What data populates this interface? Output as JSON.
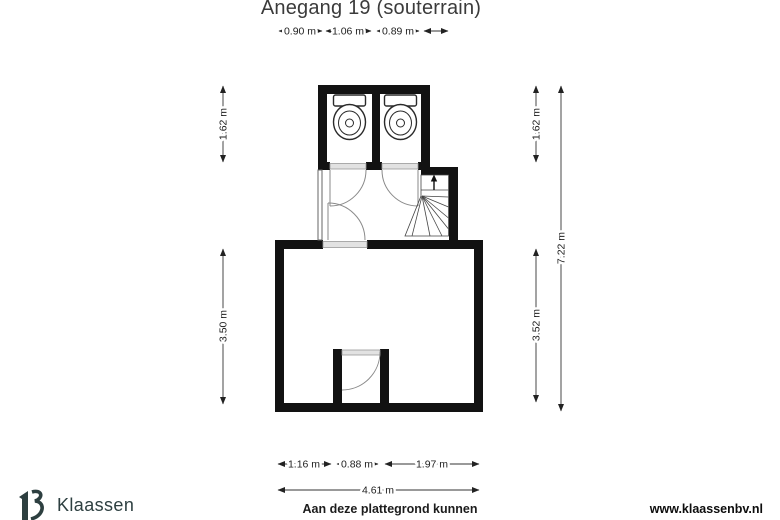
{
  "title": "Anegang 19 (souterrain)",
  "dims": {
    "top1": "0.90 m",
    "top2": "1.06 m",
    "top3": "0.89 m",
    "left_upper": "1.62 m",
    "left_lower": "3.50 m",
    "right_upper": "1.62 m",
    "right_lower": "3.52 m",
    "right_total": "7.22 m",
    "bottom1": "1.16 m",
    "bottom2": "0.88 m",
    "bottom3": "1.97 m",
    "bottom_total": "4.61 m"
  },
  "footer": {
    "brand": "Klaassen",
    "disclaimer": "Aan deze plattegrond kunnen",
    "website": "www.klaassenbv.nl"
  },
  "colors": {
    "wall": "#121212",
    "brand": "#2d3f40",
    "dimension_line": "#333333"
  }
}
